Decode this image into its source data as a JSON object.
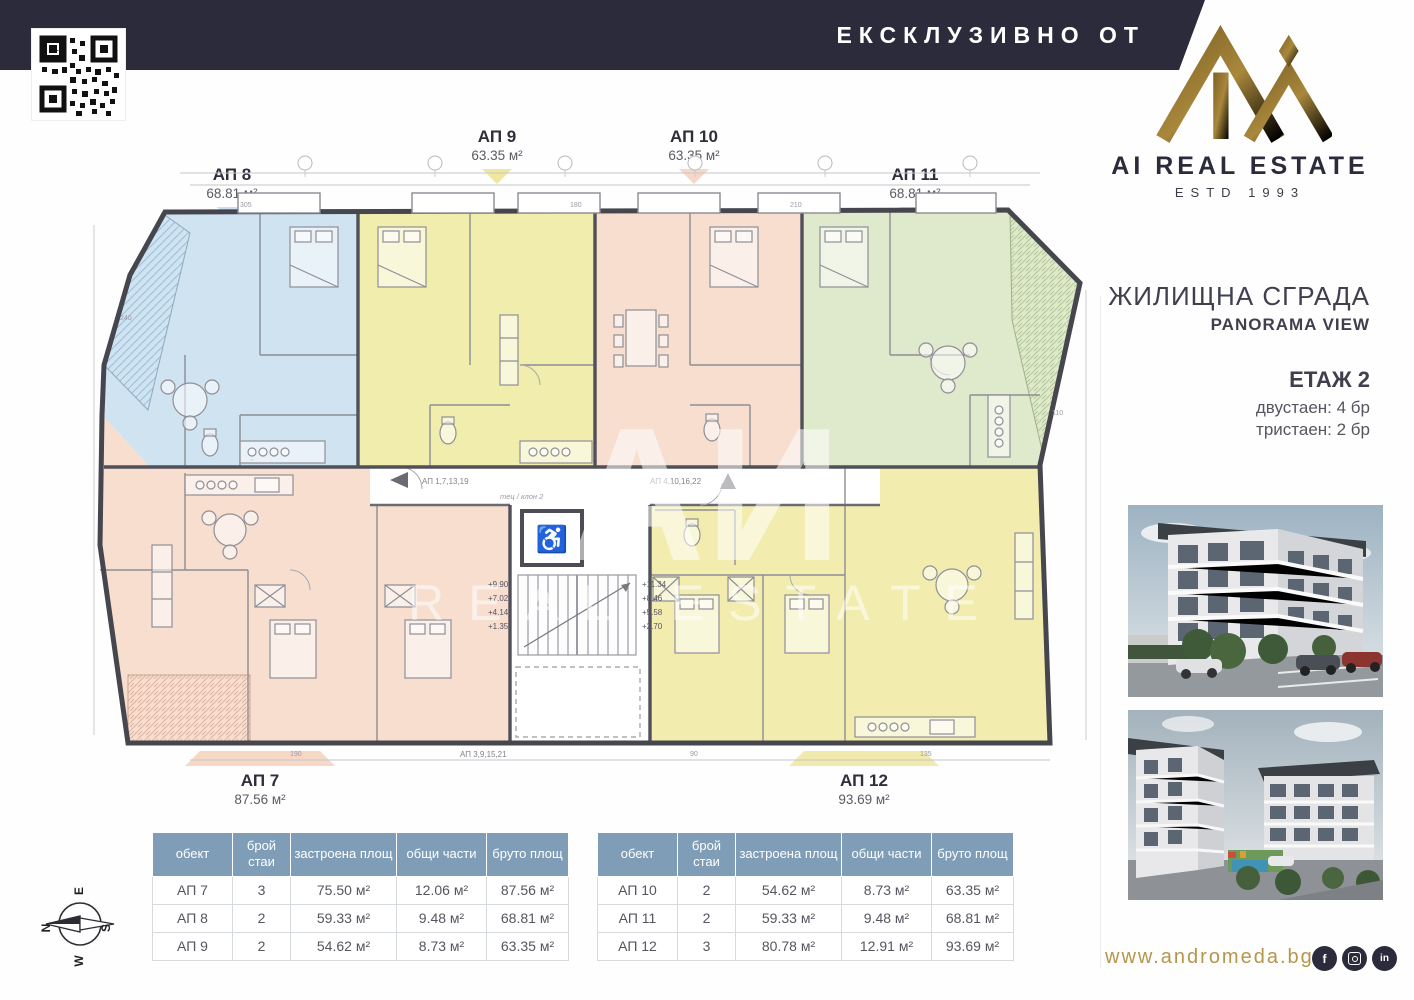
{
  "header": {
    "exclusive_label": "ЕКСКЛУЗИВНО ОТ"
  },
  "brand": {
    "name": "AI REAL ESTATE",
    "estd": "ESTD 1993"
  },
  "sidebar": {
    "title": "ЖИЛИЩНА СГРАДА",
    "subtitle": "PANORAMA VIEW",
    "floor": "ЕТАЖ 2",
    "mix1": "двустаен: 4 бр",
    "mix2": "тристаен: 2 бр",
    "website": "www.andromeda.bg",
    "facebook_glyph": "f",
    "linkedin_glyph": "in"
  },
  "apartments": [
    {
      "id": "АП 7",
      "area": "87.56 м²",
      "color": "#f7decf"
    },
    {
      "id": "АП 8",
      "area": "68.81 м²",
      "color": "#cfe3f1"
    },
    {
      "id": "АП 9",
      "area": "63.35 м²",
      "color": "#f1edac"
    },
    {
      "id": "АП 10",
      "area": "63.35 м²",
      "color": "#f7decf"
    },
    {
      "id": "АП 11",
      "area": "68.81 м²",
      "color": "#dfe9cb"
    },
    {
      "id": "АП 12",
      "area": "93.69 м²",
      "color": "#f2edae"
    }
  ],
  "plan": {
    "watermark_line1": "АИ",
    "watermark_line2": "REAL ESTATE",
    "corridor_label_1": "АП 1,7,13,19",
    "corridor_label_2": "АП 4,10,16,22",
    "corridor_label_3": "АП 3,9,15,21",
    "corridor_note": "тец / клон 2",
    "levels_left": [
      "+9.90",
      "+7.02",
      "+4.14",
      "+1.35"
    ],
    "levels_right": [
      "+11.34",
      "+8.46",
      "+5.58",
      "+2.70"
    ],
    "elevator_icon": "♿",
    "dims": [
      "305",
      "180",
      "210",
      "240",
      "110",
      "190",
      "90",
      "135"
    ],
    "wall_color": "#4d4d55"
  },
  "compass": {
    "n": "N",
    "e": "E",
    "s": "S",
    "w": "W"
  },
  "tables": {
    "headers": [
      "обект",
      "брой\nстаи",
      "застроена\nплощ",
      "общи части",
      "бруто\nплощ"
    ],
    "left": [
      [
        "АП 7",
        "3",
        "75.50 м²",
        "12.06 м²",
        "87.56 м²"
      ],
      [
        "АП 8",
        "2",
        "59.33 м²",
        "9.48 м²",
        "68.81 м²"
      ],
      [
        "АП 9",
        "2",
        "54.62 м²",
        "8.73 м²",
        "63.35 м²"
      ]
    ],
    "right": [
      [
        "АП 10",
        "2",
        "54.62 м²",
        "8.73 м²",
        "63.35 м²"
      ],
      [
        "АП 11",
        "2",
        "59.33 м²",
        "9.48 м²",
        "68.81 м²"
      ],
      [
        "АП 12",
        "3",
        "80.78 м²",
        "12.91 м²",
        "93.69 м²"
      ]
    ]
  }
}
